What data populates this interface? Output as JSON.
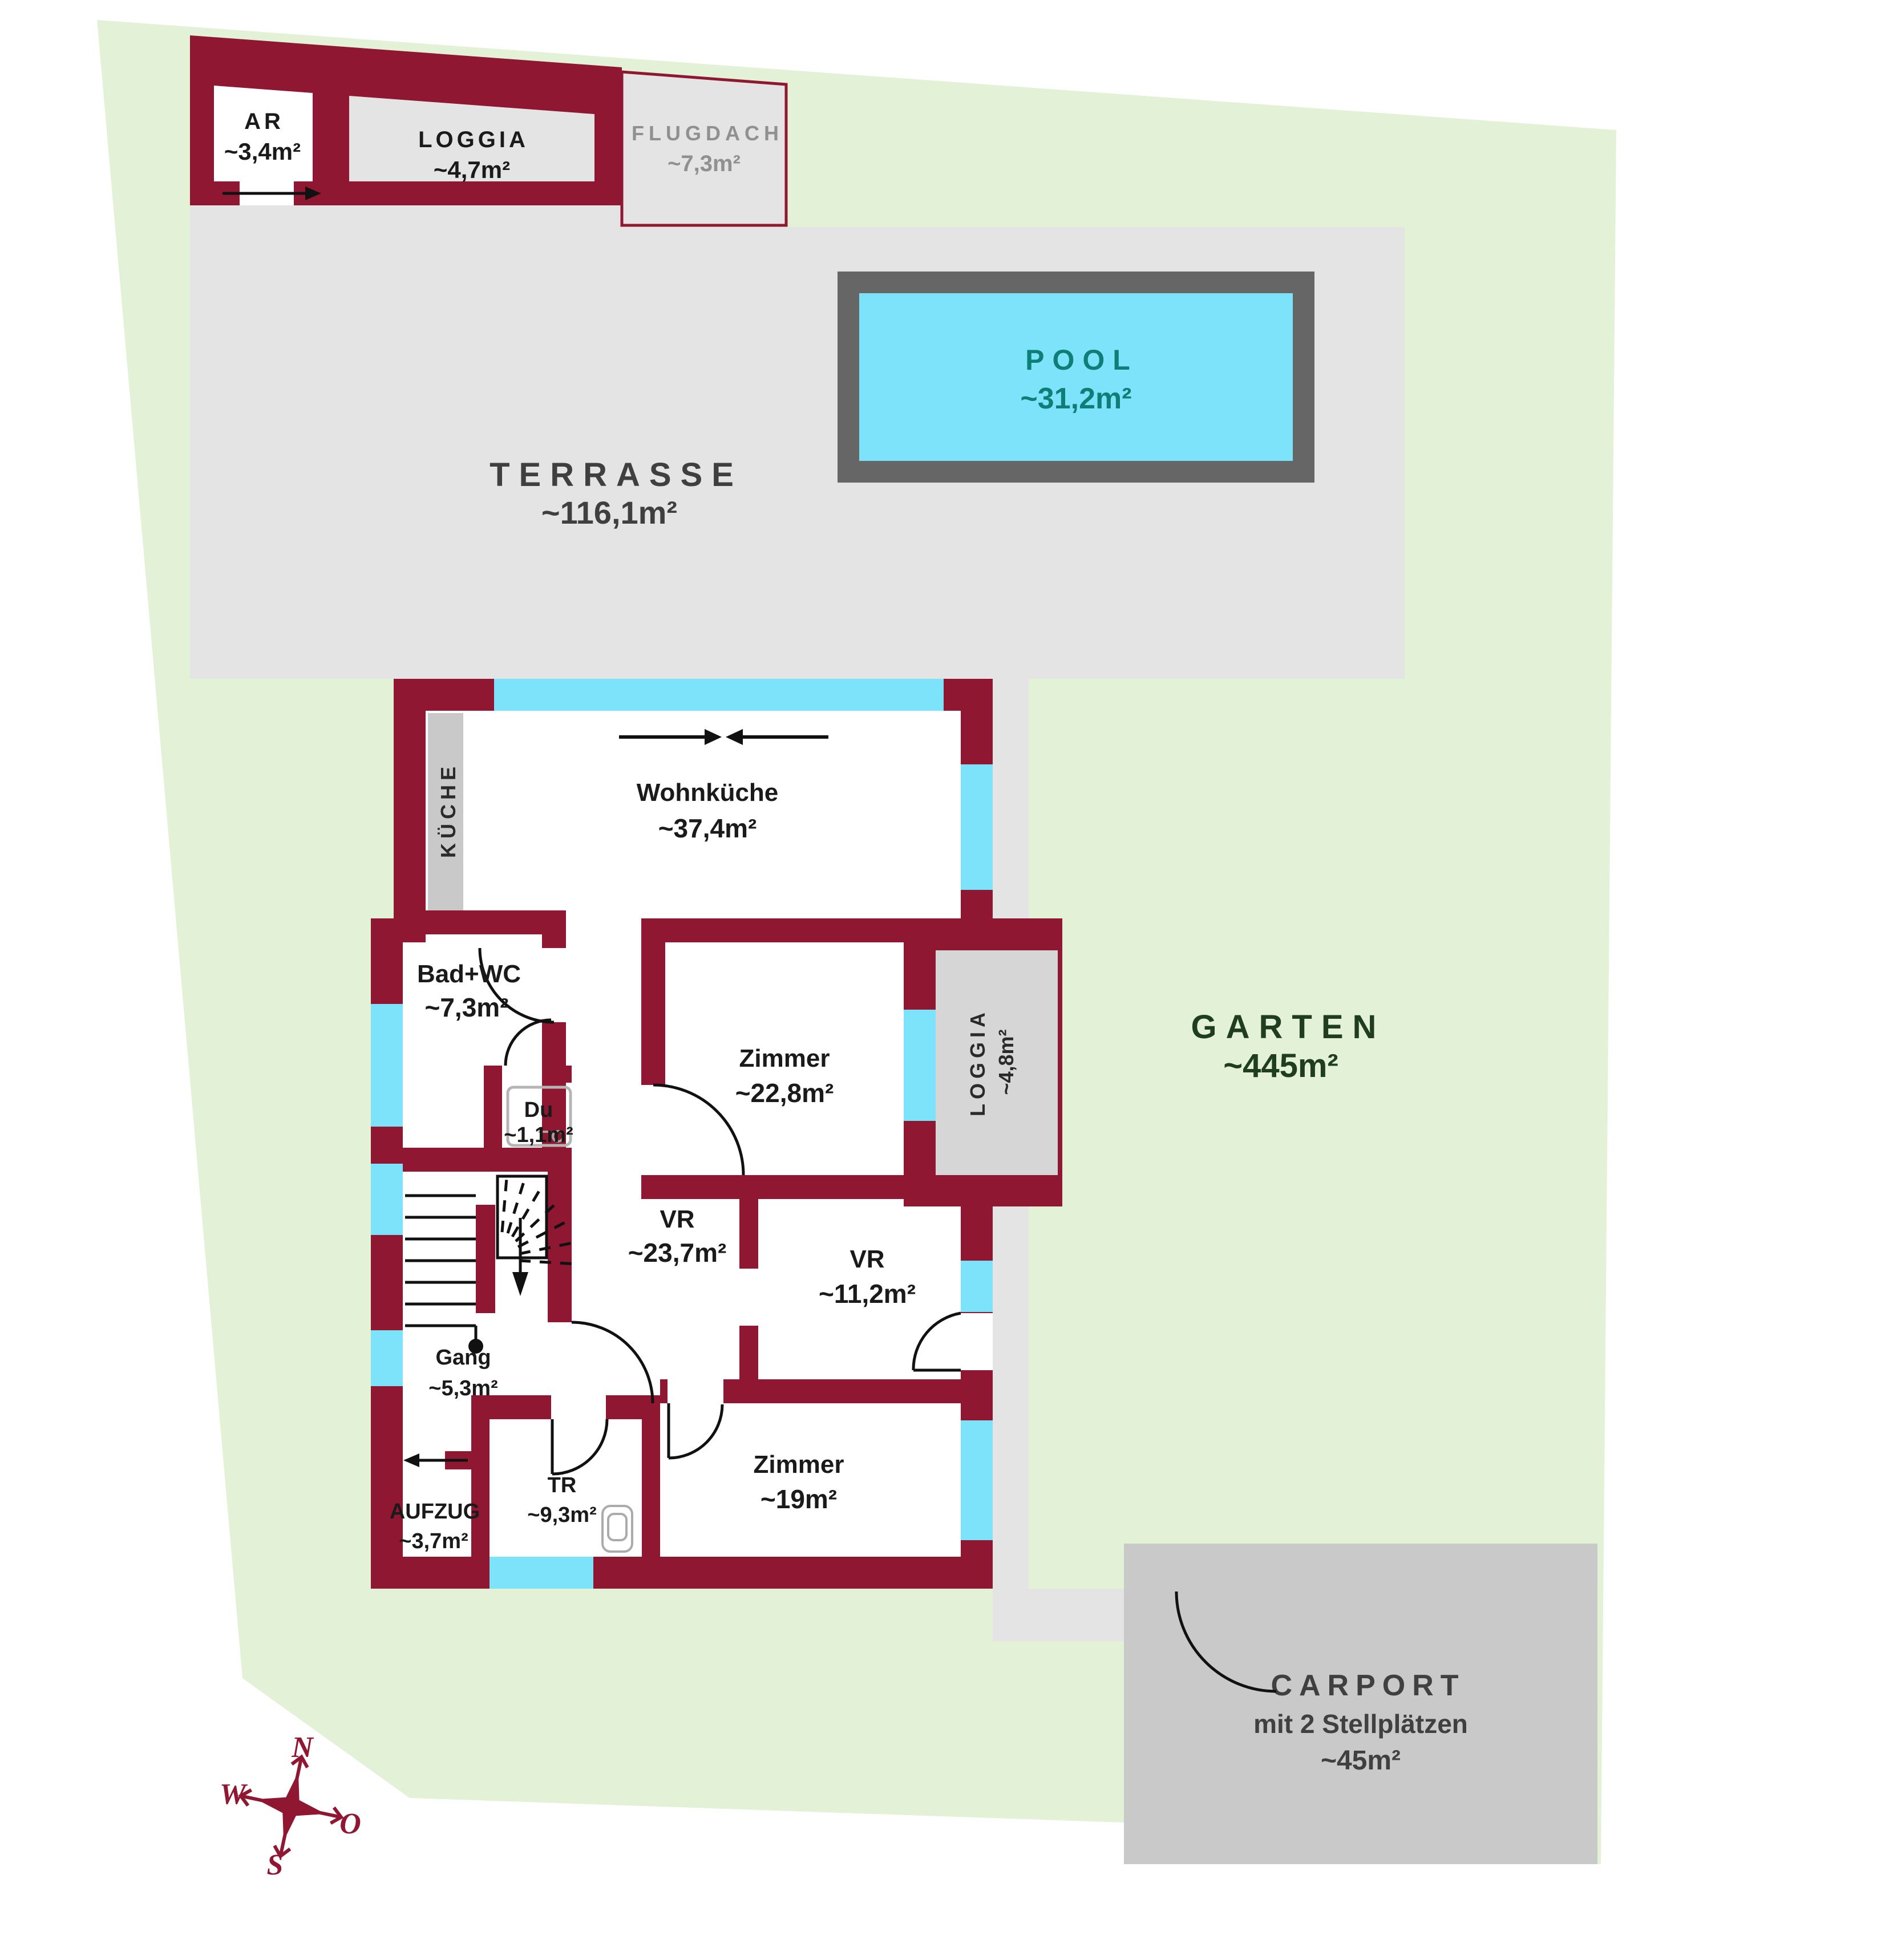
{
  "compass": {
    "north": "N",
    "south": "S",
    "west": "W",
    "east": "O"
  },
  "areas": {
    "garten": {
      "label": "GARTEN",
      "value": "~445m²"
    },
    "terrasse": {
      "label": "TERRASSE",
      "value": "~116,1m²"
    },
    "pool": {
      "label": "POOL",
      "value": "~31,2m²"
    },
    "carport": {
      "label": "CARPORT",
      "subtitle": "mit 2 Stellplätzen",
      "value": "~45m²"
    },
    "flugdach": {
      "label": "FLUGDACH",
      "value": "~7,3m²"
    }
  },
  "annex": {
    "ar": {
      "label": "AR",
      "value": "~3,4m²"
    },
    "loggia": {
      "label": "LOGGIA",
      "value": "~4,7m²"
    }
  },
  "rooms": {
    "wohnkueche": {
      "label": "Wohnküche",
      "value": "~37,4m²"
    },
    "kueche": {
      "label": "KÜCHE"
    },
    "bad_wc": {
      "label": "Bad+WC",
      "value": "~7,3m²"
    },
    "du": {
      "label": "Du",
      "value": "~1,1m²"
    },
    "vr_gross": {
      "label": "VR",
      "value": "~23,7m²"
    },
    "vr_klein": {
      "label": "VR",
      "value": "~11,2m²"
    },
    "zimmer_gross": {
      "label": "Zimmer",
      "value": "~22,8m²"
    },
    "zimmer_klein": {
      "label": "Zimmer",
      "value": "~19m²"
    },
    "gang": {
      "label": "Gang",
      "value": "~5,3m²"
    },
    "tr": {
      "label": "TR",
      "value": "~9,3m²"
    },
    "aufzug": {
      "label": "AUFZUG",
      "value": "~3,7m²"
    },
    "loggia_ost": {
      "label": "LOGGIA",
      "value": "~4,8m²"
    }
  },
  "colors": {
    "wall": "#8f1732",
    "window": "#7de3fb",
    "garden": "#e3f1d7",
    "terrace": "#e4e4e4",
    "carport": "#c9c9c9",
    "pool_rim": "#666666",
    "pool_water": "#7de3fb",
    "pool_text": "#0e7e76",
    "garten_text": "#1f3d1f"
  }
}
